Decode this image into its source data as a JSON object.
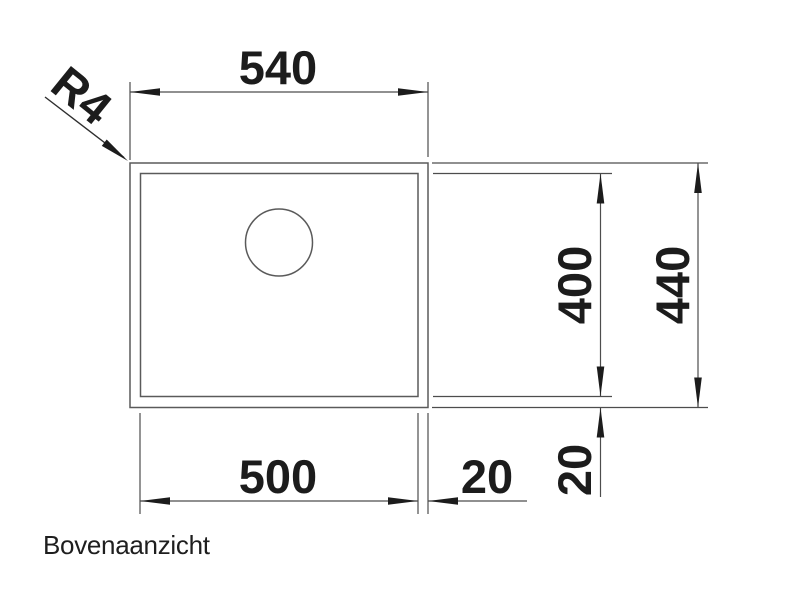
{
  "colors": {
    "background": "#ffffff",
    "line": "#4d4d4d",
    "geometry_line": "#5a5a5a",
    "ink": "#1c1c1c"
  },
  "drawing": {
    "caption": "Bovenaanzicht",
    "radius_label": "R4",
    "dimensions": {
      "outer_width": "540",
      "bowl_width": "500",
      "rim_right": "20",
      "bowl_depth": "400",
      "outer_depth": "440",
      "rim_bottom": "20"
    }
  }
}
